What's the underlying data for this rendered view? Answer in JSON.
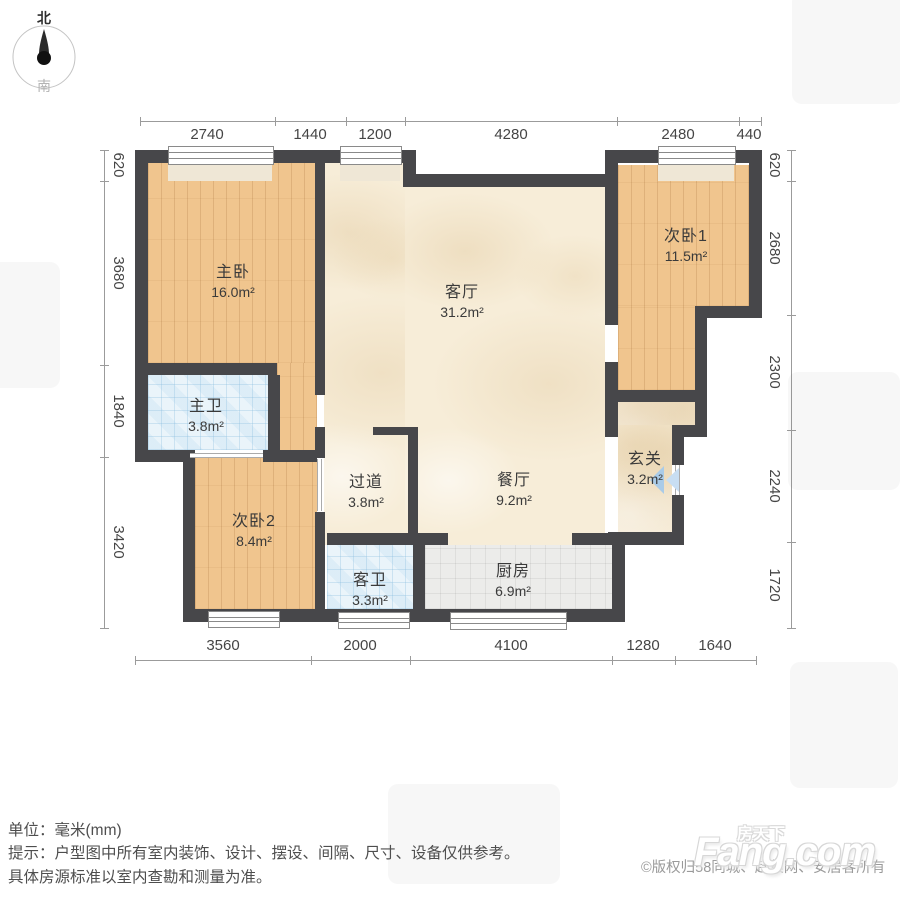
{
  "compass": {
    "north": "北",
    "south": "南"
  },
  "rooms": [
    {
      "id": "master-bedroom",
      "name": "主卧",
      "area": "16.0m²"
    },
    {
      "id": "living-room",
      "name": "客厅",
      "area": "31.2m²"
    },
    {
      "id": "bedroom-1",
      "name": "次卧1",
      "area": "11.5m²"
    },
    {
      "id": "master-bathroom",
      "name": "主卫",
      "area": "3.8m²"
    },
    {
      "id": "bedroom-2",
      "name": "次卧2",
      "area": "8.4m²"
    },
    {
      "id": "corridor",
      "name": "过道",
      "area": "3.8m²"
    },
    {
      "id": "dining-room",
      "name": "餐厅",
      "area": "9.2m²"
    },
    {
      "id": "entry",
      "name": "玄关",
      "area": "3.2m²"
    },
    {
      "id": "guest-bathroom",
      "name": "客卫",
      "area": "3.3m²"
    },
    {
      "id": "kitchen",
      "name": "厨房",
      "area": "6.9m²"
    }
  ],
  "dimensions": {
    "top": [
      "2740",
      "1440",
      "1200",
      "4280",
      "2480",
      "440"
    ],
    "left": [
      "620",
      "3680",
      "1840",
      "3420"
    ],
    "right": [
      "620",
      "2680",
      "2300",
      "2240",
      "1720"
    ],
    "bottom": [
      "3560",
      "2000",
      "4100",
      "1280",
      "1640"
    ]
  },
  "footer": {
    "unit_line": "单位：毫米(mm)",
    "tip_line": "提示：户型图中所有室内装饰、设计、摆设、间隔、尺寸、设备仅供参考。",
    "tip_line2": "具体房源标准以室内查勘和测量为准。",
    "copyright": "©版权归58同城、赶集网、安居客所有",
    "brand_cn": "房天下",
    "brand_en": "Fang.com"
  },
  "colors": {
    "wall": "#47474a",
    "wood_floor": "#f0c58e",
    "marble_floor": "#f7edd8",
    "blue_tile_floor": "#eaf4fa",
    "gray_tile_floor": "#ececea",
    "entry_arrow": "#a9cbe8",
    "dimension_text": "#454545"
  }
}
